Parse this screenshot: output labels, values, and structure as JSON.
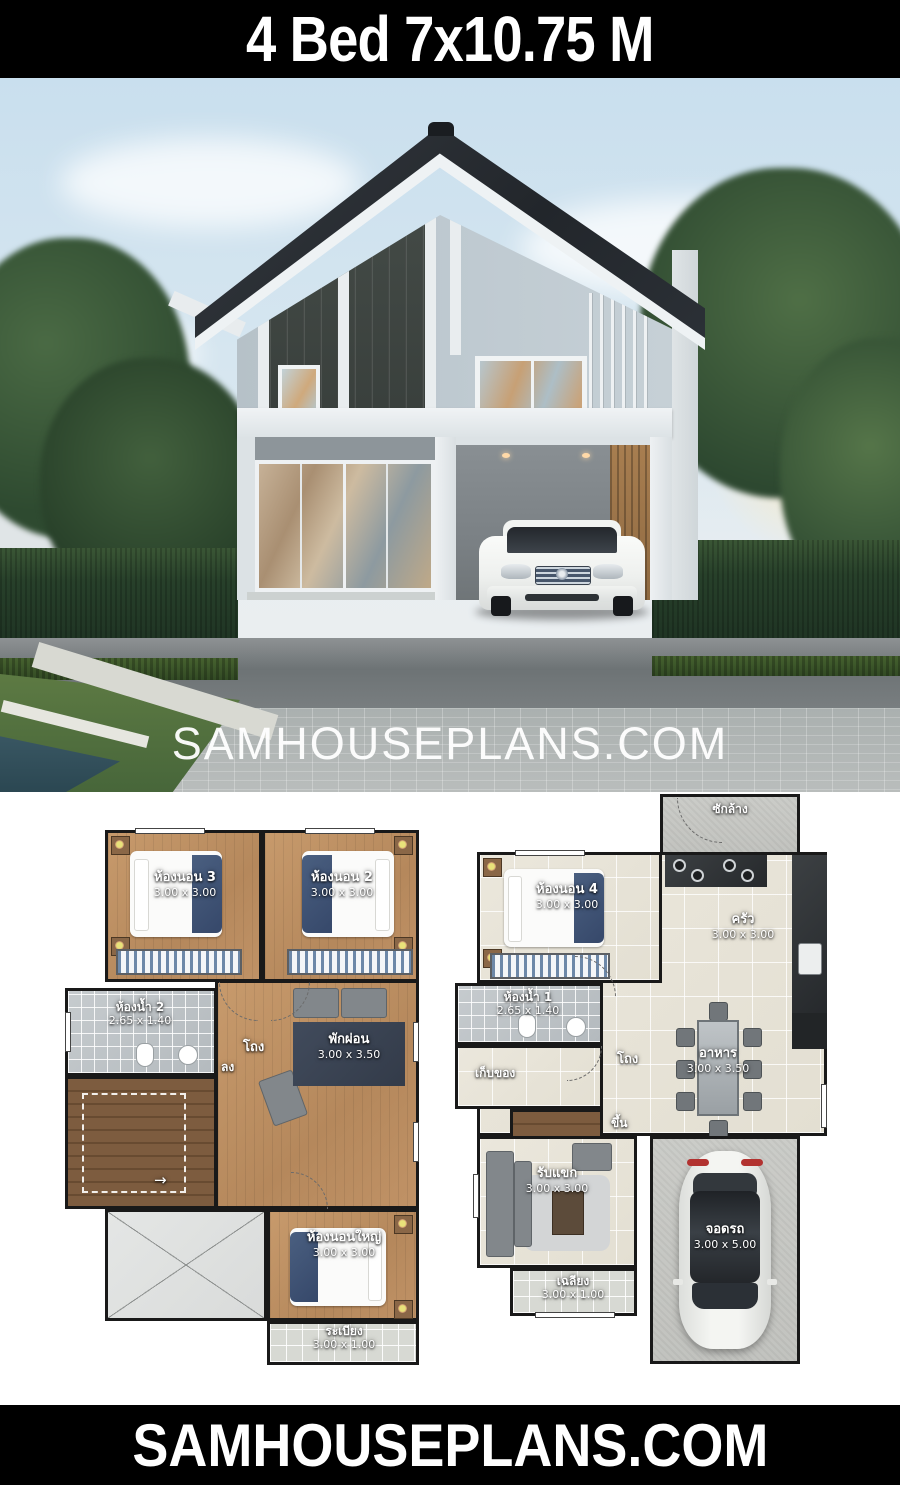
{
  "header": {
    "title": "4 Bed 7x10.75 M"
  },
  "photo": {
    "watermark": "SAMHOUSEPLANS.COM"
  },
  "footer": {
    "brand": "SAMHOUSEPLANS.COM"
  },
  "colors": {
    "header_bg": "#000000",
    "header_text": "#ffffff",
    "sky": "#cfe2ee",
    "roof": "#24282d",
    "siding_dark": "#3c423e",
    "wall_light": "#bfcad1",
    "hedge_green": "#27402a",
    "wood_floor": "#bb8e62",
    "tile_floor": "#eae6db",
    "bath_tile": "#c0c6c9",
    "concrete": "#c8c9c5",
    "rug_navy": "#3a4350",
    "label_text": "#ffffff"
  },
  "plans": {
    "second_floor": {
      "rooms": {
        "bedroom3": {
          "name": "ห้องนอน 3",
          "dims": "3.00 x 3.00"
        },
        "bedroom2": {
          "name": "ห้องนอน 2",
          "dims": "3.00 x 3.00"
        },
        "bath2": {
          "name": "ห้องน้ำ 2",
          "dims": "2.65 x 1.40"
        },
        "hall": {
          "name": "โถง"
        },
        "relax": {
          "name": "พักผ่อน",
          "dims": "3.00 x 3.50"
        },
        "master": {
          "name": "ห้องนอนใหญ่",
          "dims": "3.00 x 3.00"
        },
        "balcony": {
          "name": "ระเบียง",
          "dims": "3.00 x 1.00"
        }
      },
      "stairs": {
        "label": "ลง",
        "arrow": "→"
      }
    },
    "first_floor": {
      "rooms": {
        "laundry": {
          "name": "ซักล้าง"
        },
        "bedroom4": {
          "name": "ห้องนอน 4",
          "dims": "3.00 x 3.00"
        },
        "kitchen": {
          "name": "ครัว",
          "dims": "3.00 x 3.00"
        },
        "bath1": {
          "name": "ห้องน้ำ 1",
          "dims": "2.65 x 1.40"
        },
        "storage": {
          "name": "เก็บของ"
        },
        "hall": {
          "name": "โถง"
        },
        "dining": {
          "name": "อาหาร",
          "dims": "3.00 x 3.50"
        },
        "living": {
          "name": "รับแขก",
          "dims": "3.00 x 3.00"
        },
        "porch": {
          "name": "เฉลียง",
          "dims": "3.00 x 1.00"
        },
        "parking": {
          "name": "จอดรถ",
          "dims": "3.00 x 5.00"
        }
      },
      "stairs": {
        "label": "ขึ้น",
        "arrow": "←"
      }
    }
  }
}
